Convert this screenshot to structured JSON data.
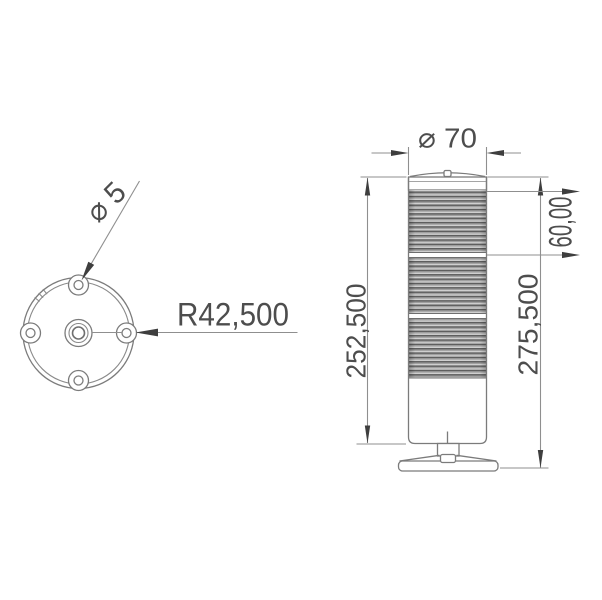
{
  "drawing": {
    "top_view": {
      "hole_diameter_label": "⌀ 5",
      "radius_label": "R42,500"
    },
    "side_view": {
      "diameter_label": "⌀ 70",
      "module_height_label": "60,00",
      "body_height_label": "252,500",
      "total_height_label": "275,500"
    },
    "colors": {
      "background": "#ffffff",
      "outline": "#7b7b7b",
      "dimension_line": "#8f8f8f",
      "arrow": "#3e3e3e",
      "text": "#4d4d4d",
      "rib_dark": "#5e5e5e",
      "rib_mid": "#9f9f9f",
      "rib_light": "#cfcfcf"
    }
  }
}
